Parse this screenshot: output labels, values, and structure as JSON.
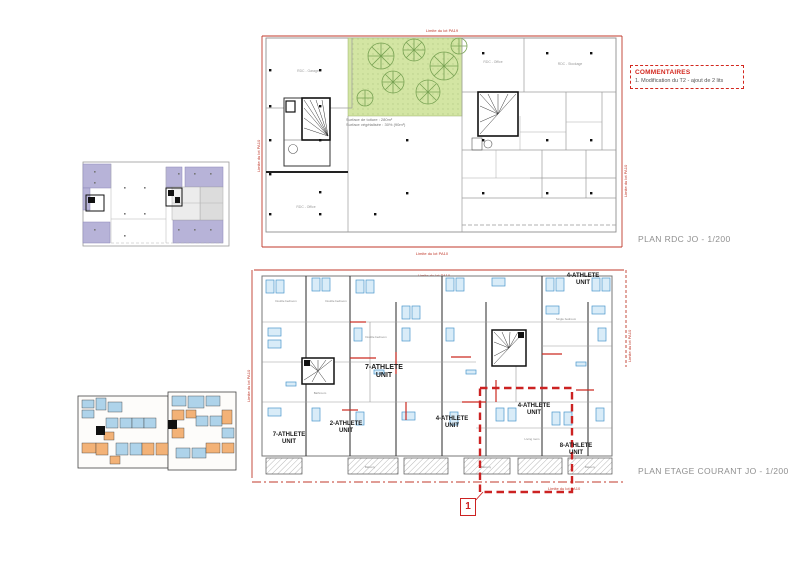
{
  "limits": {
    "pa19": "Limite du lot PA19",
    "pa10": "Limite du lot PA10"
  },
  "comments": {
    "title": "COMMENTAIRES",
    "item1": "1. Modification du T2 - ajout de 2 lits"
  },
  "rdc": {
    "caption": "PLAN RDC JO - 1/200",
    "annotation": "Surface de toiture : 280m²\nSurface végétalisée : 30% (90m²)",
    "rooms": {
      "garage": "RDC - Garage",
      "office": "RDC - Office",
      "stockage": "RDC - Stockage"
    }
  },
  "etage": {
    "caption": "PLAN ETAGE COURANT JO - 1/200",
    "marker": "1",
    "units": [
      {
        "label": "4-ATHLETE\nUNIT"
      },
      {
        "label": "7-ATHLETE\nUNIT"
      },
      {
        "label": "2-ATHLETE\nUNIT"
      },
      {
        "label": "4-ATHLETE\nUNIT"
      },
      {
        "label": "7-ATHLETE\nUNIT"
      },
      {
        "label": "4-ATHLETE\nUNIT"
      },
      {
        "label": "8-ATHLETE\nUNIT"
      }
    ],
    "rooms_small": {
      "double": "Double bedroom",
      "single": "Single bedroom",
      "bath": "Bathroom",
      "living": "Living room",
      "balcony": "Balcony"
    }
  },
  "colors": {
    "red_accent": "#d3271e",
    "plan_red": "#c0392b",
    "garden_green": "#d3e5a3",
    "tree_green": "#79a354",
    "key_lavender": "#b7b3d8",
    "furniture_blue": "#4a97cc",
    "key_blue": "#aed3ea",
    "key_orange": "#f3b277",
    "caption_gray": "#8f8f8f"
  }
}
